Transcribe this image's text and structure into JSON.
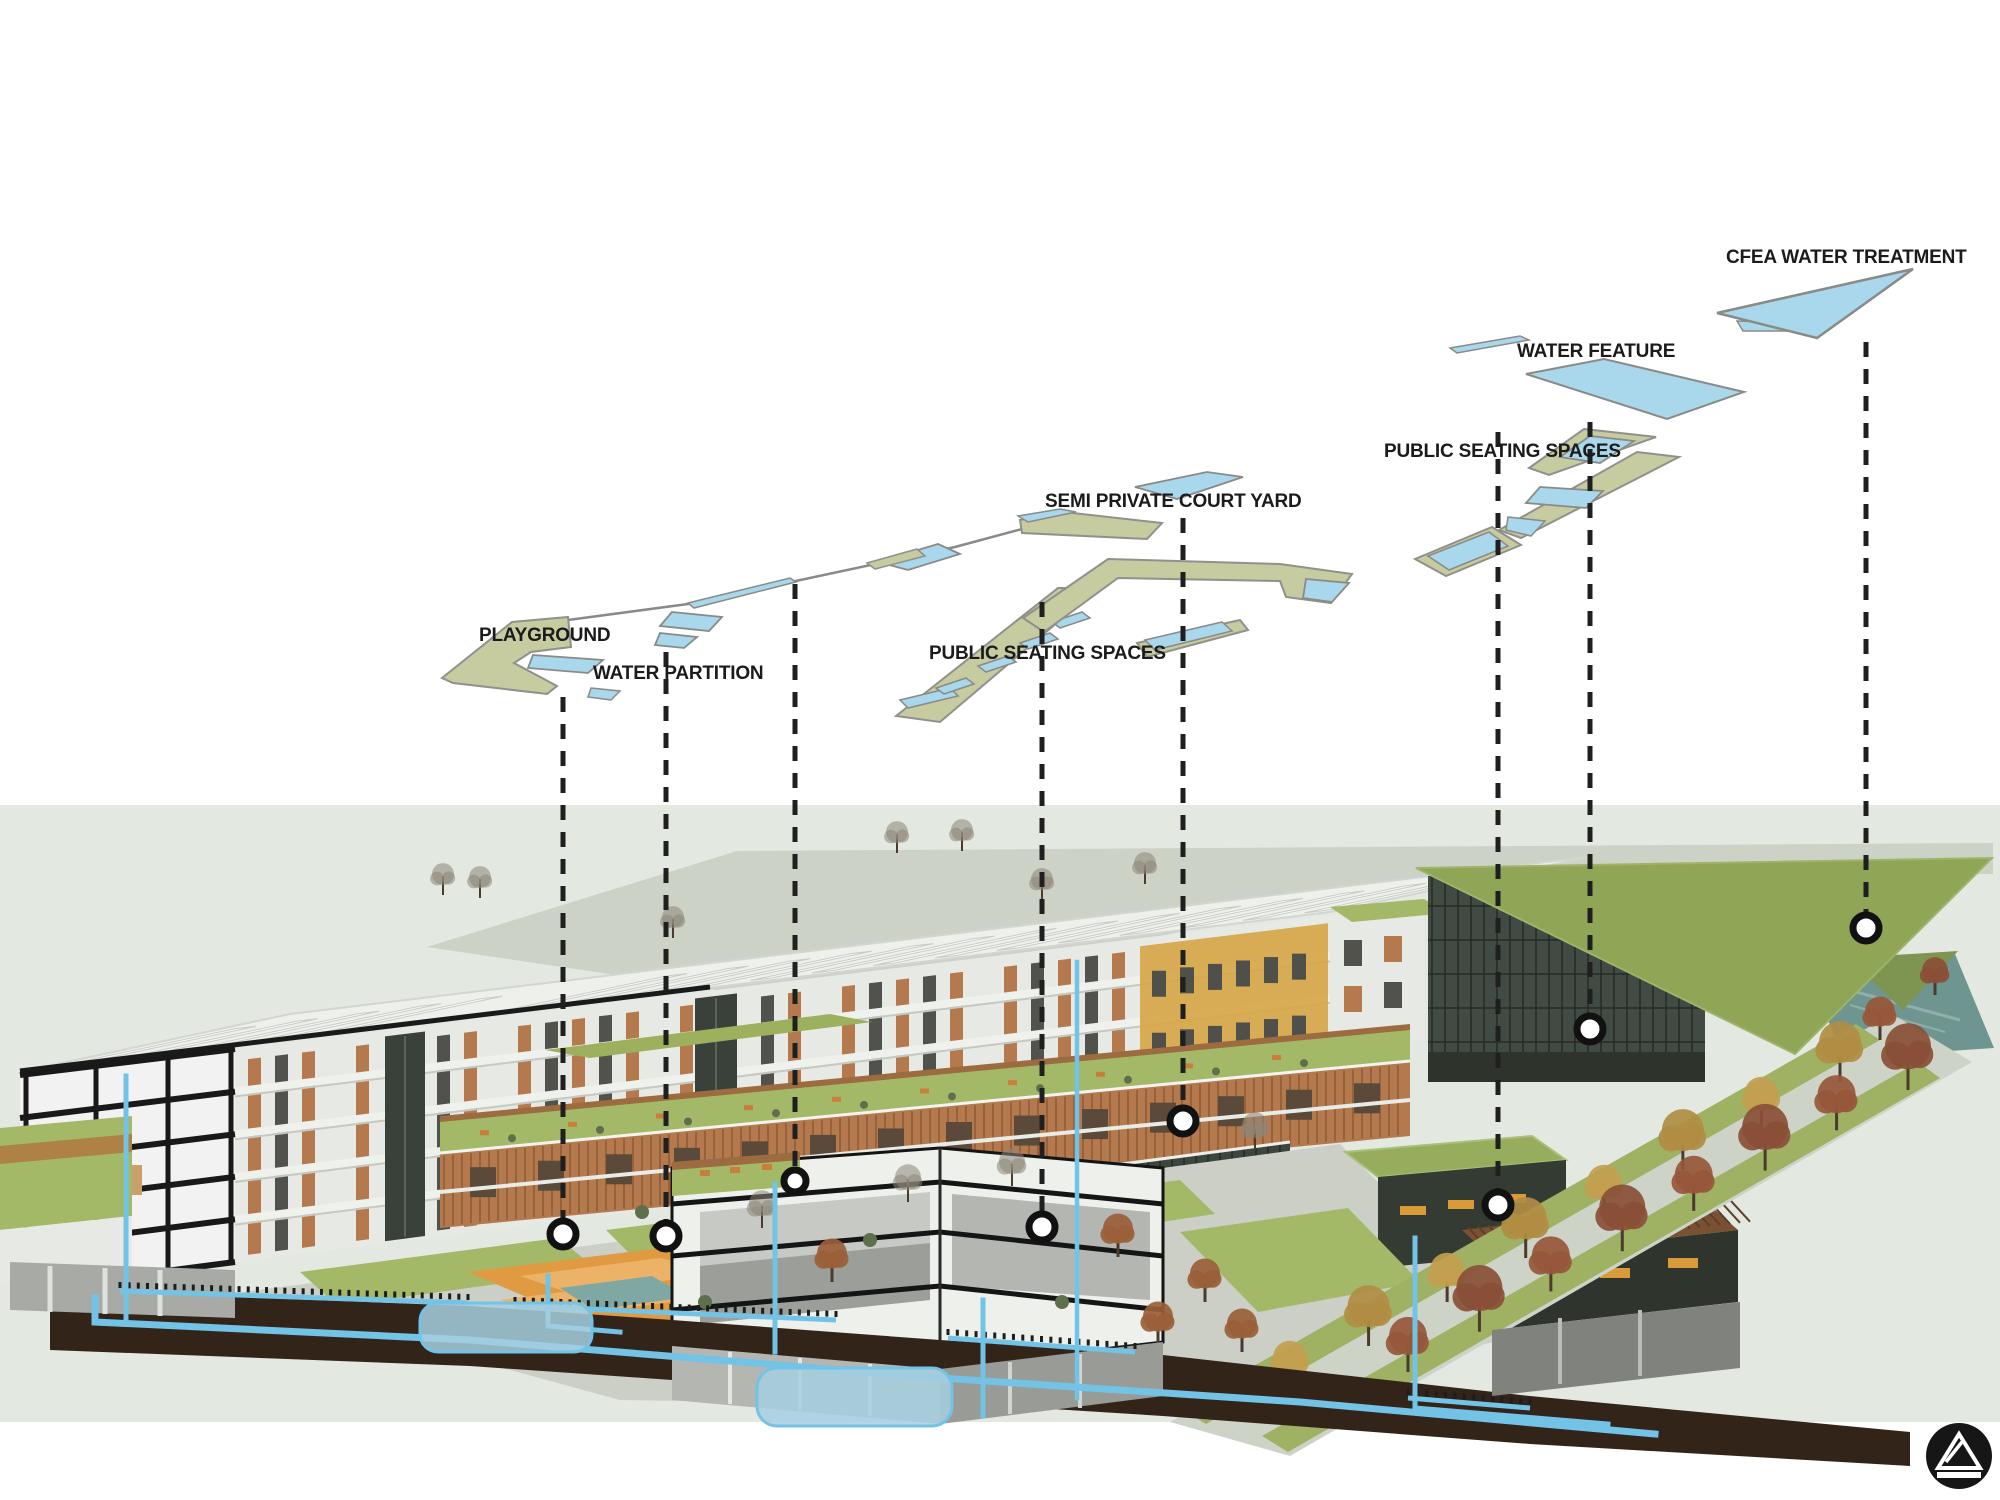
{
  "diagram": {
    "type": "exploded-axonometric-architecture-water-system-diagram",
    "labels": [
      {
        "id": "playground",
        "text": "PLAYGROUND",
        "x": 479,
        "y": 626
      },
      {
        "id": "water-partition",
        "text": "WATER PARTITION",
        "x": 593,
        "y": 664
      },
      {
        "id": "public-seating-center",
        "text": "PUBLIC SEATING SPACES",
        "x": 929,
        "y": 644
      },
      {
        "id": "semi-private-court-yard",
        "text": "SEMI PRIVATE COURT YARD",
        "x": 1045,
        "y": 492
      },
      {
        "id": "public-seating-right",
        "text": "PUBLIC SEATING SPACES",
        "x": 1384,
        "y": 442
      },
      {
        "id": "water-feature",
        "text": "WATER FEATURE",
        "x": 1517,
        "y": 342
      },
      {
        "id": "cfea-water-treatment",
        "text": "CFEA WATER TREATMENT",
        "x": 1726,
        "y": 248
      }
    ],
    "leader_lines": [
      {
        "label": "playground",
        "x": 563,
        "y_top": 697,
        "y_bottom": 1219,
        "node_y": 1234,
        "node_r": 13
      },
      {
        "label": "water-partition",
        "x": 666,
        "y_top": 652,
        "y_bottom": 1221,
        "node_y": 1236,
        "node_r": 13
      },
      {
        "label": "",
        "x": 795,
        "y_top": 584,
        "y_bottom": 1167,
        "node_y": 1181,
        "node_r": 11
      },
      {
        "label": "public-seating-center",
        "x": 1042,
        "y_top": 602,
        "y_bottom": 1212,
        "node_y": 1227,
        "node_r": 13
      },
      {
        "label": "semi-private-court-yard",
        "x": 1183,
        "y_top": 518,
        "y_bottom": 1106,
        "node_y": 1121,
        "node_r": 13
      },
      {
        "label": "public-seating-right",
        "x": 1498,
        "y_top": 432,
        "y_bottom": 1190,
        "node_y": 1205,
        "node_r": 13
      },
      {
        "label": "water-feature",
        "x": 1590,
        "y_top": 422,
        "y_bottom": 1015,
        "node_y": 1029,
        "node_r": 13
      },
      {
        "label": "cfea-water-treatment",
        "x": 1866,
        "y_top": 342,
        "y_bottom": 914,
        "node_y": 928,
        "node_r": 13
      }
    ],
    "colors": {
      "background": "#ffffff",
      "site_band": "#e3e8e1",
      "ground_plane": "#cdd2c6",
      "plan_area_green": "#c6cba0",
      "plan_water_blue": "#a9d7ec",
      "plan_outline": "#8a8a86",
      "pipe_blue": "#72c3e6",
      "tank_blue": "#a6cfe0",
      "soil_brown": "#33241a",
      "lawn_green": "#a3b968",
      "roof_green": "#8fa657",
      "wood_brown": "#b5794e",
      "ochre_wall": "#d5a544",
      "glass_dark": "#39413a",
      "building_white": "#eef0ec",
      "canal_teal": "#7fa8a2",
      "playground_orange": "#e09a42",
      "leader_line": "#1f1f1f",
      "label_text": "#1b1b1b"
    },
    "logo": {
      "name": "triangle-in-circle-logo",
      "color": "#161616"
    }
  }
}
